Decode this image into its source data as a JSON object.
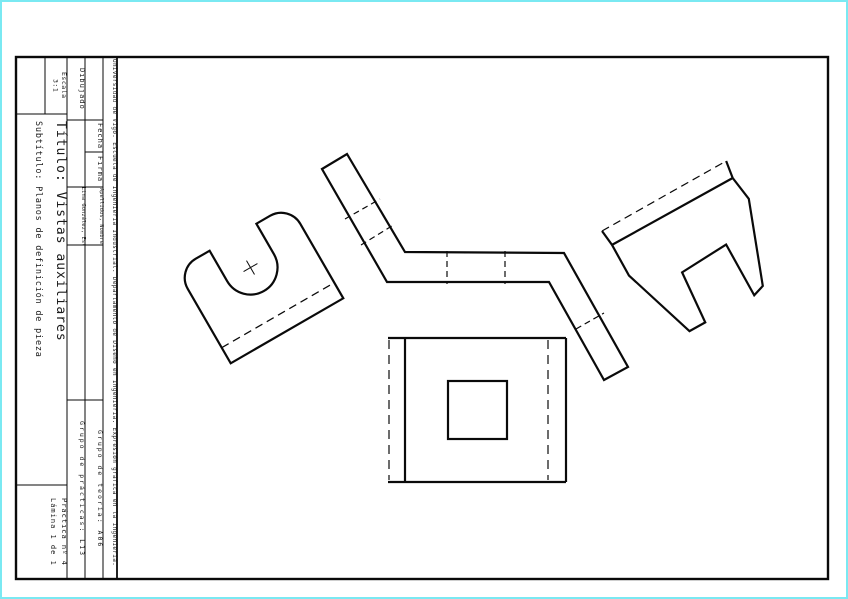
{
  "colors": {
    "page_border": "#7ae9f2",
    "line": "#0a0a0a"
  },
  "title_block": {
    "university_line": "Universidad de Vigo. Escuela de Ingeniería Industrial. Departamento de Diseño en Ingeniería. Expresión gráfica en la ingeniería.",
    "dibujado_label": "Dibujado",
    "fecha_label": "Fecha",
    "firma_label": "Firma",
    "apellidos_header": "Apellidos, Nombre",
    "apellidos_value": "Lina González, Estela",
    "grupo_teoria": "Grupo de teoría: A06",
    "grupo_practicas": "Grupo de prácticas: L13",
    "escala_label": "Escala",
    "escala_value": "3:1",
    "titulo": "Título: Vistas auxiliares",
    "subtitulo": "Subtítulo: Planos de definición de pieza",
    "practica": "Práctica nº 4",
    "lamina": "Lámina 1 de 1"
  }
}
